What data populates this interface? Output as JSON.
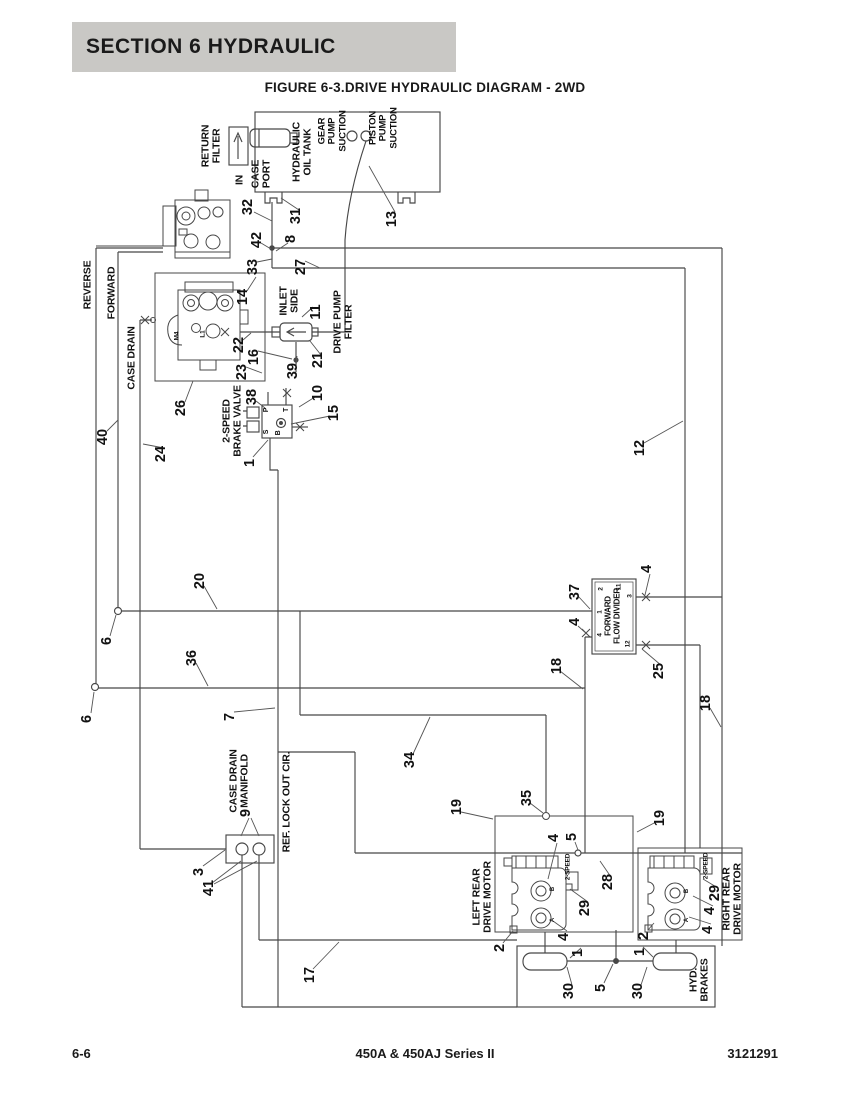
{
  "page": {
    "header": "SECTION 6   HYDRAULIC",
    "figure_title": "FIGURE 6-3.DRIVE HYDRAULIC DIAGRAM - 2WD",
    "footer": {
      "page_number": "6-6",
      "model": "450A & 450AJ Series II",
      "doc_number": "3121291"
    }
  },
  "colors": {
    "header_band": "#c9c8c5",
    "line": "#474747",
    "text": "#111111",
    "page_bg": "#ffffff"
  },
  "diagram": {
    "labels": [
      {
        "text": "RETURN\nFILTER",
        "x": 212,
        "y": 146
      },
      {
        "text": "IN",
        "x": 240,
        "y": 180
      },
      {
        "text": "CASE\nPORT",
        "x": 262,
        "y": 174
      },
      {
        "text": "HYDRAULIC\nOIL TANK",
        "x": 303,
        "y": 152
      },
      {
        "text": "GEAR\nPUMP\nSUCTION",
        "x": 333,
        "y": 131,
        "size": 9.5
      },
      {
        "text": "PISTON\nPUMP\nSUCTION",
        "x": 384,
        "y": 128,
        "size": 9.5
      },
      {
        "text": "REVERSE",
        "x": 88,
        "y": 285
      },
      {
        "text": "FORWARD",
        "x": 112,
        "y": 293
      },
      {
        "text": "CASE DRAIN",
        "x": 132,
        "y": 358
      },
      {
        "text": "INLET\nSIDE",
        "x": 290,
        "y": 301
      },
      {
        "text": "DRIVE PUMP\nFILTER",
        "x": 344,
        "y": 322
      },
      {
        "text": "2-SPEED\nBRAKE VALVE",
        "x": 233,
        "y": 421
      },
      {
        "text": "FORWARD\nFLOW DIVIDER",
        "x": 613,
        "y": 616,
        "size": 8
      },
      {
        "text": "CASE DRAIN\nMANIFOLD",
        "x": 240,
        "y": 781
      },
      {
        "text": "REF. LOCK OUT CIR.",
        "x": 287,
        "y": 802
      },
      {
        "text": "LEFT REAR\nDRIVE MOTOR",
        "x": 483,
        "y": 897
      },
      {
        "text": "RIGHT REAR\nDRIVE MOTOR",
        "x": 733,
        "y": 899
      },
      {
        "text": "2-SPEED",
        "x": 568,
        "y": 867,
        "size": 6.5
      },
      {
        "text": "2-SPEED",
        "x": 706,
        "y": 866,
        "size": 6.5
      },
      {
        "text": "HYD.\nBRAKES",
        "x": 700,
        "y": 980
      },
      {
        "text": "P",
        "x": 267,
        "y": 410,
        "size": 7
      },
      {
        "text": "T",
        "x": 287,
        "y": 410,
        "size": 7
      },
      {
        "text": "S",
        "x": 267,
        "y": 432,
        "size": 7
      },
      {
        "text": "B",
        "x": 279,
        "y": 433,
        "size": 7
      },
      {
        "text": "M4",
        "x": 177,
        "y": 336,
        "size": 6.5
      },
      {
        "text": "L1",
        "x": 203,
        "y": 334,
        "size": 6.5
      },
      {
        "text": "2",
        "x": 601,
        "y": 589,
        "size": 6.5
      },
      {
        "text": "11",
        "x": 619,
        "y": 587,
        "size": 6.5
      },
      {
        "text": "1",
        "x": 600,
        "y": 612,
        "size": 6.5
      },
      {
        "text": "3",
        "x": 630,
        "y": 596,
        "size": 6.5
      },
      {
        "text": "4",
        "x": 600,
        "y": 635,
        "size": 6.5
      },
      {
        "text": "12",
        "x": 628,
        "y": 644,
        "size": 6.5
      },
      {
        "text": "B",
        "x": 553,
        "y": 889,
        "size": 6
      },
      {
        "text": "A",
        "x": 553,
        "y": 920,
        "size": 6
      },
      {
        "text": "B",
        "x": 687,
        "y": 891,
        "size": 6
      },
      {
        "text": "A",
        "x": 687,
        "y": 920,
        "size": 6
      }
    ],
    "callouts": [
      {
        "n": "32",
        "x": 248,
        "y": 207
      },
      {
        "n": "31",
        "x": 296,
        "y": 216
      },
      {
        "n": "13",
        "x": 392,
        "y": 219
      },
      {
        "n": "42",
        "x": 257,
        "y": 240
      },
      {
        "n": "8",
        "x": 291,
        "y": 239
      },
      {
        "n": "33",
        "x": 253,
        "y": 267
      },
      {
        "n": "27",
        "x": 301,
        "y": 267
      },
      {
        "n": "14",
        "x": 243,
        "y": 297
      },
      {
        "n": "11",
        "x": 316,
        "y": 312
      },
      {
        "n": "22",
        "x": 239,
        "y": 345
      },
      {
        "n": "16",
        "x": 254,
        "y": 357
      },
      {
        "n": "23",
        "x": 242,
        "y": 372
      },
      {
        "n": "39",
        "x": 293,
        "y": 371
      },
      {
        "n": "21",
        "x": 318,
        "y": 360
      },
      {
        "n": "26",
        "x": 181,
        "y": 408
      },
      {
        "n": "38",
        "x": 252,
        "y": 397
      },
      {
        "n": "10",
        "x": 318,
        "y": 393
      },
      {
        "n": "15",
        "x": 334,
        "y": 413
      },
      {
        "n": "40",
        "x": 103,
        "y": 437
      },
      {
        "n": "24",
        "x": 161,
        "y": 454
      },
      {
        "n": "1",
        "x": 250,
        "y": 463
      },
      {
        "n": "12",
        "x": 640,
        "y": 448
      },
      {
        "n": "20",
        "x": 200,
        "y": 581
      },
      {
        "n": "37",
        "x": 575,
        "y": 592
      },
      {
        "n": "4",
        "x": 647,
        "y": 569
      },
      {
        "n": "4",
        "x": 575,
        "y": 622
      },
      {
        "n": "6",
        "x": 107,
        "y": 641
      },
      {
        "n": "36",
        "x": 192,
        "y": 658
      },
      {
        "n": "18",
        "x": 557,
        "y": 666
      },
      {
        "n": "25",
        "x": 659,
        "y": 671
      },
      {
        "n": "6",
        "x": 87,
        "y": 719
      },
      {
        "n": "7",
        "x": 230,
        "y": 717
      },
      {
        "n": "18",
        "x": 706,
        "y": 703
      },
      {
        "n": "34",
        "x": 410,
        "y": 760
      },
      {
        "n": "9",
        "x": 246,
        "y": 813
      },
      {
        "n": "19",
        "x": 457,
        "y": 807
      },
      {
        "n": "35",
        "x": 527,
        "y": 798
      },
      {
        "n": "19",
        "x": 660,
        "y": 818
      },
      {
        "n": "3",
        "x": 199,
        "y": 872
      },
      {
        "n": "41",
        "x": 209,
        "y": 888
      },
      {
        "n": "4",
        "x": 554,
        "y": 838
      },
      {
        "n": "5",
        "x": 572,
        "y": 837
      },
      {
        "n": "28",
        "x": 608,
        "y": 882
      },
      {
        "n": "29",
        "x": 585,
        "y": 908
      },
      {
        "n": "4",
        "x": 564,
        "y": 937
      },
      {
        "n": "2",
        "x": 500,
        "y": 948
      },
      {
        "n": "29",
        "x": 715,
        "y": 893
      },
      {
        "n": "4",
        "x": 710,
        "y": 911
      },
      {
        "n": "4",
        "x": 708,
        "y": 930
      },
      {
        "n": "2",
        "x": 644,
        "y": 936
      },
      {
        "n": "1",
        "x": 578,
        "y": 953
      },
      {
        "n": "1",
        "x": 640,
        "y": 952
      },
      {
        "n": "30",
        "x": 569,
        "y": 991
      },
      {
        "n": "5",
        "x": 601,
        "y": 988
      },
      {
        "n": "30",
        "x": 638,
        "y": 991
      },
      {
        "n": "17",
        "x": 310,
        "y": 975
      }
    ]
  }
}
